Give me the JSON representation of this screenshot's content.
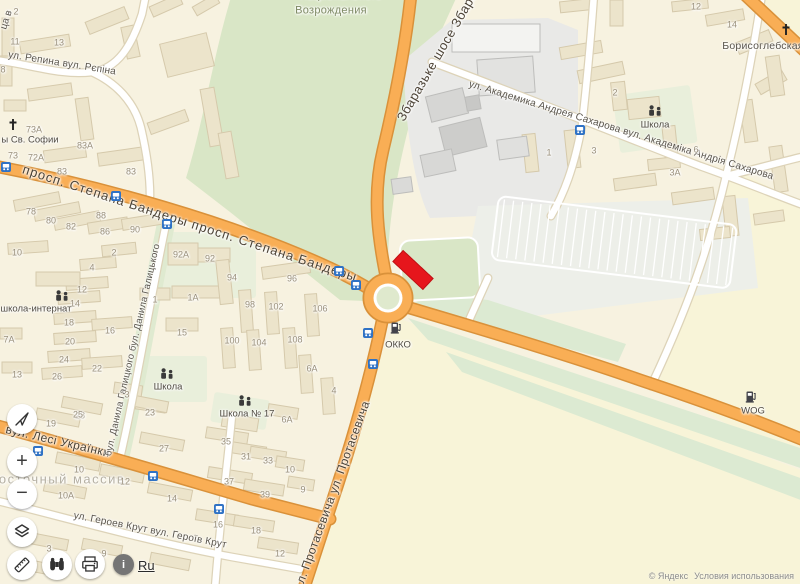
{
  "app": {
    "title": "Карта"
  },
  "colors": {
    "bg": "#f7f2e0",
    "field": "#f8f4d8",
    "park": "#d9e6c6",
    "yard": "#e9efdb",
    "gray_zone": "#e9e9e7",
    "parking_zone": "#edefe9",
    "green_band": "#dcead2",
    "boulevard_green": "#dfead0",
    "road_fill": "#f9ae55",
    "road_casing": "#d9913a",
    "minor_fill": "#ffffff",
    "minor_casing": "#ddd3b8",
    "building": "#ece4cb",
    "building_stroke": "#d5c9ab",
    "bus_blue": "#2f72c5",
    "marker_red": "#e6161c"
  },
  "controls": {
    "zoom_in": "+",
    "zoom_out": "−",
    "info": "i",
    "language": "Ru"
  },
  "attribution": {
    "copyright": "© Яндекс",
    "terms": "Условия использования"
  },
  "marker": {
    "x": 413,
    "y": 270,
    "w": 42,
    "h": 16,
    "rotate": 43
  },
  "road_labels": [
    {
      "t": "просп. Степана Бандеры   просп. Степана Бандеры",
      "x": 190,
      "y": 223,
      "r": 18,
      "cls": "road-major",
      "fs": 13,
      "ls": 1
    },
    {
      "t": "Збаразьке шосе Збара",
      "x": 437,
      "y": 56,
      "r": -60,
      "cls": "road-major",
      "fs": 13,
      "ls": 0.5
    },
    {
      "t": "л. Протасевича ул. Протасевича",
      "x": 333,
      "y": 492,
      "r": -70,
      "cls": "road-major",
      "fs": 12,
      "ls": 0.4
    },
    {
      "t": "вул. Лесі Українки",
      "x": 58,
      "y": 441,
      "r": 13,
      "cls": "road-major",
      "fs": 12,
      "ls": 0.4
    },
    {
      "t": "ул. Академика Андрея Сахарова вул. Академіка Андрія Сахарова",
      "x": 621,
      "y": 131,
      "r": 17,
      "cls": "road-minor",
      "fs": 10,
      "ls": 0.2
    },
    {
      "t": "ул. Героев Крут вул. Героїв Крут",
      "x": 150,
      "y": 531,
      "r": 11,
      "cls": "road-minor",
      "fs": 10,
      "ls": 0.2
    },
    {
      "t": "ул. Репина вул. Рєпіна",
      "x": 62,
      "y": 64,
      "r": 9,
      "cls": "road-minor",
      "fs": 10,
      "ls": 0.2
    },
    {
      "t": "бул. Данила Галицкого  бул. Данила Галицького",
      "x": 133,
      "y": 350,
      "r": -77,
      "cls": "road-minor",
      "fs": 9.5,
      "ls": 0.2
    },
    {
      "t": "Борисоглебская",
      "x": 763,
      "y": 46,
      "r": 0,
      "cls": "road-minor",
      "fs": 10.5,
      "ls": 0.2
    },
    {
      "t": "ца в",
      "x": 7,
      "y": 20,
      "r": -72,
      "cls": "road-minor",
      "fs": 10,
      "ls": 0
    }
  ],
  "area_labels": [
    {
      "t": "Восточный массив",
      "x": 57,
      "y": 479,
      "cls": "district",
      "fs": 13,
      "ls": 1.5
    },
    {
      "t": "Возрождения",
      "x": 331,
      "y": 11,
      "cls": "park-label",
      "fs": 11,
      "ls": 0.3
    },
    {
      "t": "Национального",
      "x": 340,
      "y": -4,
      "cls": "park-label",
      "fs": 11,
      "ls": 0.3
    }
  ],
  "poi": [
    {
      "type": "church",
      "x": 13,
      "y": 127,
      "label": "ы Св. Софии",
      "lx": 30,
      "ly": 140
    },
    {
      "type": "church",
      "x": 786,
      "y": 32,
      "label": "",
      "lx": 0,
      "ly": 0
    },
    {
      "type": "school",
      "x": 62,
      "y": 297,
      "label": "школа-интернат",
      "lx": 36,
      "ly": 309
    },
    {
      "type": "school",
      "x": 167,
      "y": 375,
      "label": "Школа",
      "lx": 168,
      "ly": 387
    },
    {
      "type": "school",
      "x": 245,
      "y": 402,
      "label": "Школа № 17",
      "lx": 247,
      "ly": 414
    },
    {
      "type": "school",
      "x": 655,
      "y": 112,
      "label": "Школа",
      "lx": 655,
      "ly": 125
    },
    {
      "type": "fuel",
      "x": 396,
      "y": 330,
      "label": "ОККО",
      "lx": 398,
      "ly": 345
    },
    {
      "type": "fuel",
      "x": 751,
      "y": 399,
      "label": "WOG",
      "lx": 753,
      "ly": 411
    }
  ],
  "bus_stops": [
    [
      6,
      164
    ],
    [
      116,
      193
    ],
    [
      167,
      221
    ],
    [
      339,
      268
    ],
    [
      356,
      282
    ],
    [
      368,
      330
    ],
    [
      373,
      361
    ],
    [
      38,
      448
    ],
    [
      153,
      473
    ],
    [
      219,
      506
    ],
    [
      580,
      127
    ]
  ],
  "house_numbers": [
    [
      "2",
      16,
      12
    ],
    [
      "11",
      15,
      42
    ],
    [
      "13",
      59,
      43
    ],
    [
      "8",
      3,
      70
    ],
    [
      "73А",
      34,
      130
    ],
    [
      "83А",
      85,
      146
    ],
    [
      "73",
      13,
      156
    ],
    [
      "72А",
      36,
      158
    ],
    [
      "83",
      62,
      172
    ],
    [
      "83",
      131,
      172
    ],
    [
      "78",
      31,
      212
    ],
    [
      "80",
      51,
      221
    ],
    [
      "82",
      71,
      227
    ],
    [
      "88",
      101,
      216
    ],
    [
      "86",
      105,
      232
    ],
    [
      "90",
      135,
      230
    ],
    [
      "10",
      17,
      253
    ],
    [
      "2",
      114,
      253
    ],
    [
      "4",
      92,
      268
    ],
    [
      "12",
      82,
      290
    ],
    [
      "14",
      75,
      304
    ],
    [
      "18",
      69,
      323
    ],
    [
      "16",
      110,
      331
    ],
    [
      "20",
      70,
      342
    ],
    [
      "24",
      64,
      360
    ],
    [
      "22",
      97,
      369
    ],
    [
      "26",
      57,
      377
    ],
    [
      "13",
      17,
      375
    ],
    [
      "7А",
      9,
      340
    ],
    [
      "92А",
      181,
      255
    ],
    [
      "92",
      210,
      259
    ],
    [
      "1",
      155,
      300
    ],
    [
      "1А",
      193,
      298
    ],
    [
      "94",
      232,
      278
    ],
    [
      "96",
      292,
      279
    ],
    [
      "98",
      250,
      305
    ],
    [
      "102",
      276,
      307
    ],
    [
      "106",
      320,
      309
    ],
    [
      "100",
      232,
      341
    ],
    [
      "104",
      259,
      343
    ],
    [
      "108",
      295,
      340
    ],
    [
      "15",
      182,
      333
    ],
    [
      "6А",
      312,
      369
    ],
    [
      "4",
      334,
      391
    ],
    [
      "3",
      127,
      395
    ],
    [
      "23",
      150,
      413
    ],
    [
      "28",
      80,
      416
    ],
    [
      "19",
      51,
      424
    ],
    [
      "25",
      78,
      415
    ],
    [
      "27",
      164,
      449
    ],
    [
      "10",
      79,
      470
    ],
    [
      "12",
      125,
      482
    ],
    [
      "10А",
      66,
      496
    ],
    [
      "14",
      172,
      499
    ],
    [
      "3",
      49,
      549
    ],
    [
      "9",
      104,
      554
    ],
    [
      "35",
      226,
      442
    ],
    [
      "31",
      246,
      457
    ],
    [
      "33",
      268,
      461
    ],
    [
      "10",
      290,
      470
    ],
    [
      "37",
      229,
      482
    ],
    [
      "39",
      265,
      495
    ],
    [
      "9",
      303,
      490
    ],
    [
      "16",
      218,
      525
    ],
    [
      "18",
      256,
      531
    ],
    [
      "12",
      280,
      554
    ],
    [
      "6А",
      287,
      420
    ],
    [
      "12",
      696,
      7
    ],
    [
      "14",
      732,
      25
    ],
    [
      "2",
      615,
      93
    ],
    [
      "1",
      549,
      153
    ],
    [
      "3",
      594,
      151
    ],
    [
      "6",
      696,
      150
    ],
    [
      "3А",
      675,
      173
    ]
  ]
}
